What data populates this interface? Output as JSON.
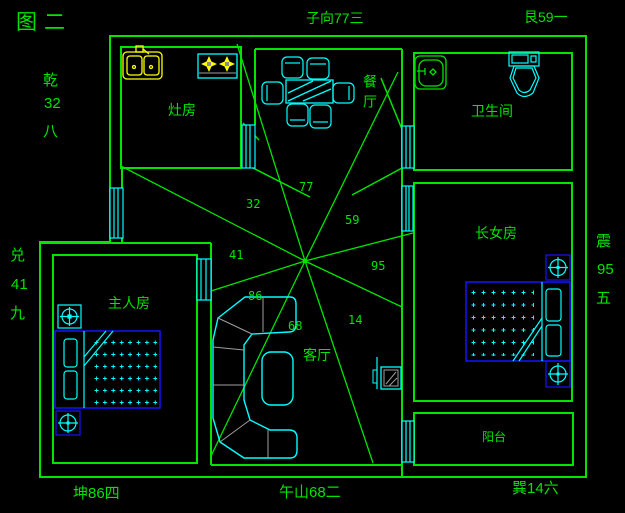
{
  "figure": {
    "title": "图二"
  },
  "perimeter": {
    "top_center": "子向77三",
    "top_right": "艮59一",
    "bottom_left": "坤86四",
    "bottom_center": "午山68二",
    "bottom_right": "巽14六",
    "left_upper": {
      "trigram": "乾",
      "number": "32",
      "numeral": "八"
    },
    "left_lower": {
      "trigram": "兑",
      "number": "41",
      "numeral": "九"
    },
    "right_side": {
      "trigram": "震",
      "number": "95",
      "numeral": "五"
    }
  },
  "rooms": {
    "kitchen": "灶房",
    "dining": "餐厅",
    "bathroom": "卫生间",
    "daughter_bedroom": "长女房",
    "master_bedroom": "主人房",
    "living_room": "客厅",
    "balcony": "阳台"
  },
  "compass_sectors": [
    {
      "direction": "north",
      "value": "77"
    },
    {
      "direction": "northwest",
      "value": "32"
    },
    {
      "direction": "northeast",
      "value": "59"
    },
    {
      "direction": "west",
      "value": "41"
    },
    {
      "direction": "east",
      "value": "95"
    },
    {
      "direction": "southwest",
      "value": "86"
    },
    {
      "direction": "south",
      "value": "68"
    },
    {
      "direction": "southeast",
      "value": "14"
    }
  ],
  "colors": {
    "background": "#000000",
    "walls_and_text": "#00e400",
    "furniture": "#00ffff",
    "bed_frames": "#1414ff",
    "kitchen_fixtures": "#ffff00",
    "sofa_seams": "#9e9e9e"
  }
}
